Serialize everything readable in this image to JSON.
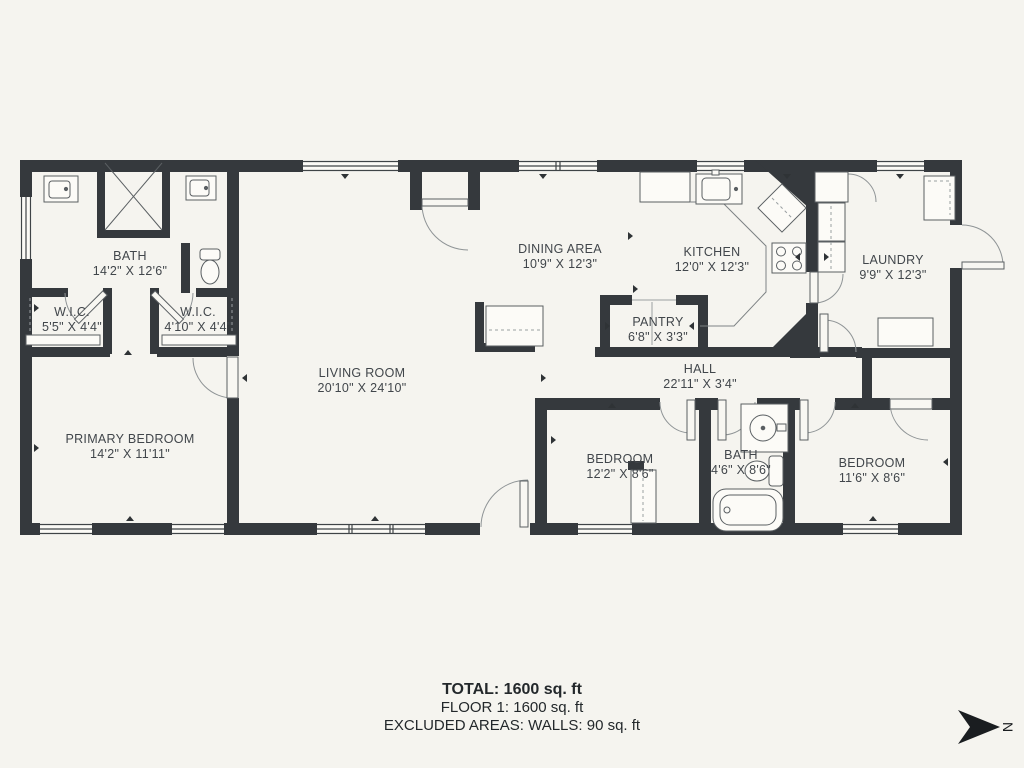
{
  "rooms": [
    {
      "name": "BATH",
      "dims": "14'2\" X 12'6\""
    },
    {
      "name": "W.I.C.",
      "dims": "5'5\" X 4'4\""
    },
    {
      "name": "W.I.C.",
      "dims": "4'10\" X 4'4\""
    },
    {
      "name": "DINING AREA",
      "dims": "10'9\" X 12'3\""
    },
    {
      "name": "KITCHEN",
      "dims": "12'0\" X 12'3\""
    },
    {
      "name": "LAUNDRY",
      "dims": "9'9\" X 12'3\""
    },
    {
      "name": "PANTRY",
      "dims": "6'8\" X 3'3\""
    },
    {
      "name": "LIVING ROOM",
      "dims": "20'10\" X 24'10\""
    },
    {
      "name": "HALL",
      "dims": "22'11\" X 3'4\""
    },
    {
      "name": "PRIMARY BEDROOM",
      "dims": "14'2\" X 11'11\""
    },
    {
      "name": "BEDROOM",
      "dims": "12'2\" X 8'6\""
    },
    {
      "name": "BATH",
      "dims": "4'6\" X 8'6\""
    },
    {
      "name": "BEDROOM",
      "dims": "11'6\" X 8'6\""
    }
  ],
  "summary": {
    "total": "TOTAL: 1600 sq. ft",
    "floor": "FLOOR 1: 1600 sq. ft",
    "excluded": "EXCLUDED AREAS: WALLS: 90 sq. ft"
  },
  "compass": {
    "label": "N"
  },
  "colors": {
    "wall": "#35393d",
    "background": "#f5f4ef"
  }
}
